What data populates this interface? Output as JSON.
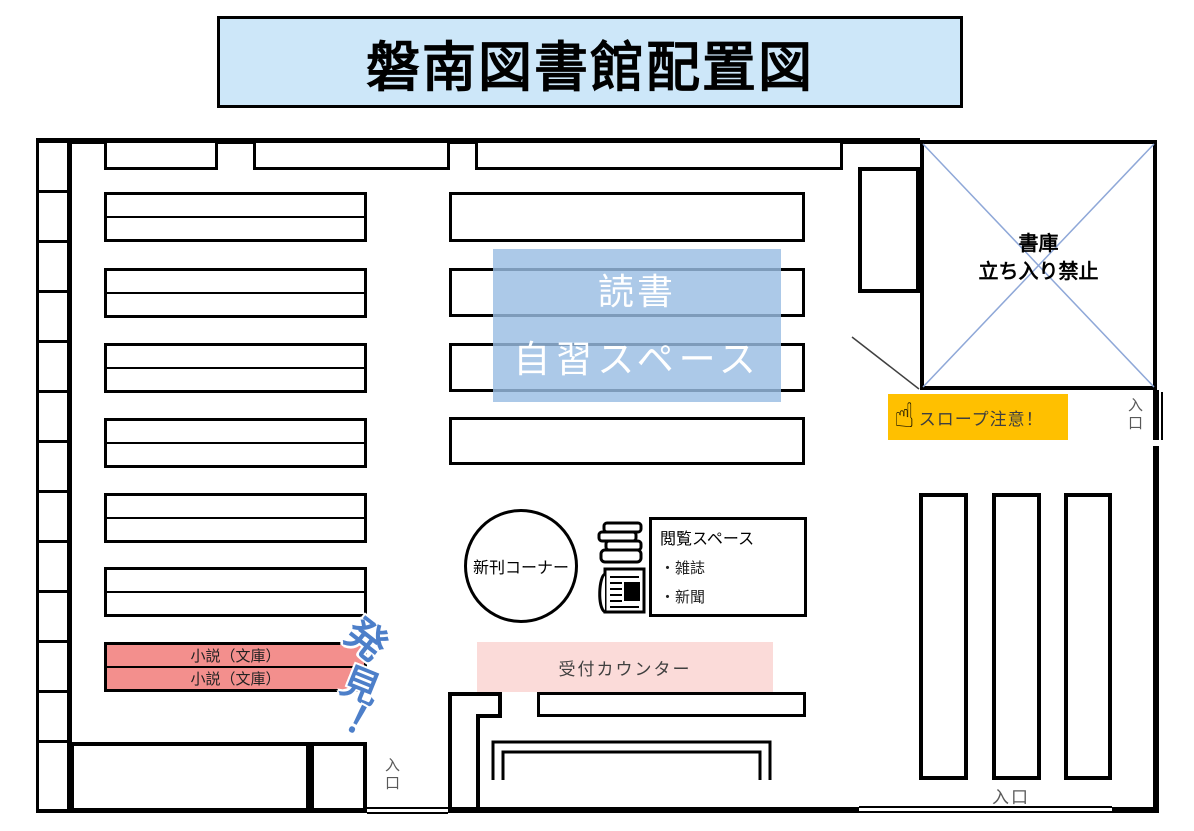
{
  "title": "磐南図書館配置図",
  "study_space": {
    "line1": "読書",
    "line2": "自習スペース"
  },
  "stacks": {
    "line1": "書庫",
    "line2": "立ち入り禁止"
  },
  "slope": {
    "label": "スロープ注意！",
    "hand_icon": "☝"
  },
  "new_books_corner": {
    "label": "新刊コーナー"
  },
  "browsing_space": {
    "title": "閲覧スペース",
    "items": [
      "・雑誌",
      "・新聞"
    ]
  },
  "reception": {
    "label": "受付カウンター"
  },
  "novel_shelf": {
    "rows": [
      "小説（文庫）",
      "小説（文庫）"
    ]
  },
  "discovery_sticker": {
    "chars": [
      "発",
      "見",
      "！"
    ]
  },
  "entrances": {
    "stacks_side": "入口",
    "bottom_left": "入口",
    "bottom_right": "入口"
  },
  "colors": {
    "title_bg": "#cde7f9",
    "study_overlay": "#9abde3",
    "stacks_cross": "#8fa8d8",
    "novel_shelf_bg": "#f38f8d",
    "reception_bg": "#fbdbd9",
    "slope_bg": "#ffc000",
    "discovery_blue": "#4d7fc9"
  }
}
